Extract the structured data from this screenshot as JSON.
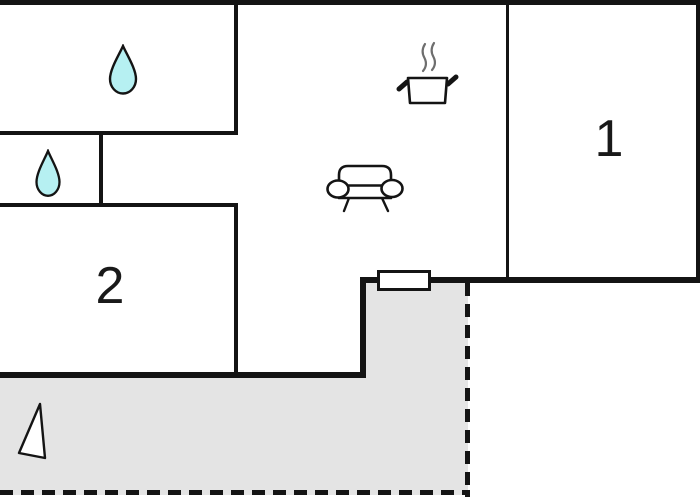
{
  "floorplan": {
    "room_labels": [
      {
        "name": "room-1",
        "text": "1"
      },
      {
        "name": "room-2",
        "text": "2"
      }
    ],
    "icons": [
      "water-drop-icon",
      "water-drop-icon",
      "cooking-pot-icon",
      "sofa-icon",
      "north-arrow-icon"
    ],
    "colors": {
      "wall": "#141414",
      "background": "#ffffff",
      "terrace_fill": "#e4e4e4",
      "water_drop_fill": "#b6f0f2",
      "steam_stroke": "#6e6e6e",
      "label_color": "#191919"
    },
    "features": {
      "terrace_boundary": "dashed",
      "door_opening": "white-rect-on-wall"
    }
  }
}
